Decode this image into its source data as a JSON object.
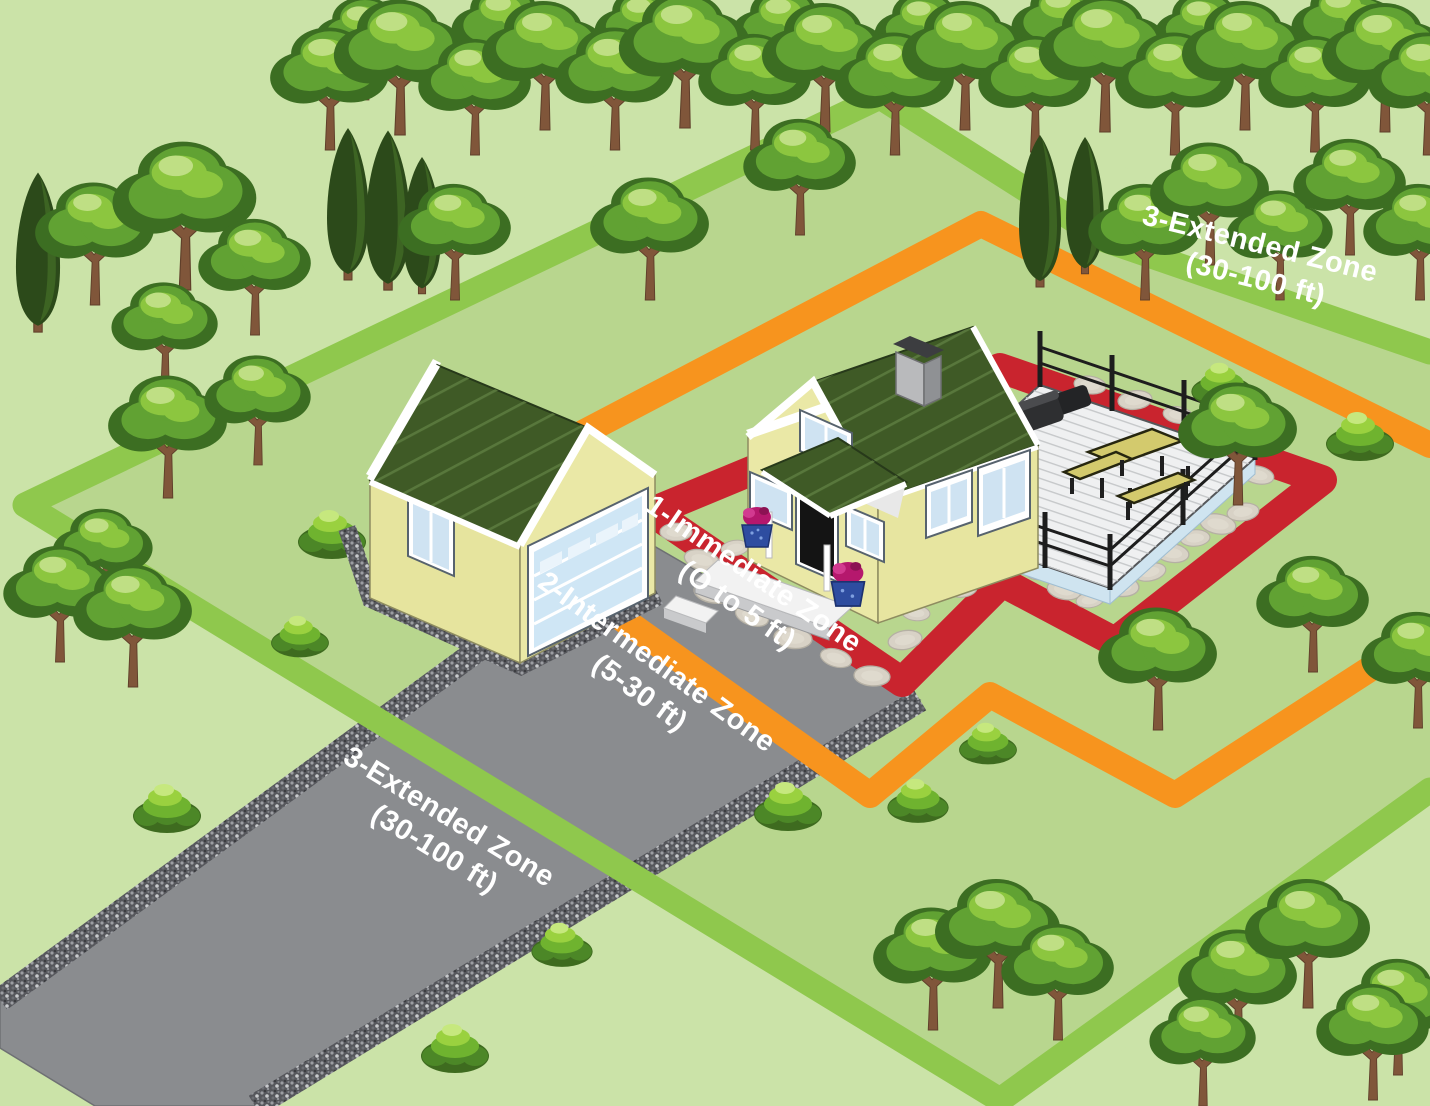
{
  "illustration": {
    "kind": "defensible-space-zones-diagram",
    "zones": [
      {
        "name": "immediate",
        "label": {
          "line1": "1-Immediate Zone",
          "line2": "(O to 5 ft)"
        },
        "color": "#c9242e"
      },
      {
        "name": "intermediate",
        "label": {
          "line1": "2-Intermediate Zone",
          "line2": "(5-30 ft)"
        },
        "color": "#f7941e"
      },
      {
        "name": "extended",
        "label": {
          "line1": "3-Extended Zone",
          "line2": "(30-100 ft)"
        },
        "color": "#8fc84d",
        "label_count": 2
      }
    ],
    "palette": {
      "grass": "#b8d68e",
      "grass_light": "#cbe3a8",
      "driveway": "#8a8c8f",
      "gravel": "#56575c",
      "roof": "#3f5a26",
      "wall": "#eae8a6",
      "trim": "#ffffff",
      "window": "#cfe3f2",
      "deck": "#eff0f1",
      "label_text": "#ffffff"
    },
    "scene_objects": [
      "forest-trees",
      "conifer-trees",
      "bushes",
      "garage",
      "house",
      "deck-with-fence",
      "picnic-table",
      "grill",
      "driveway",
      "gravel-strips",
      "stone-path"
    ]
  }
}
